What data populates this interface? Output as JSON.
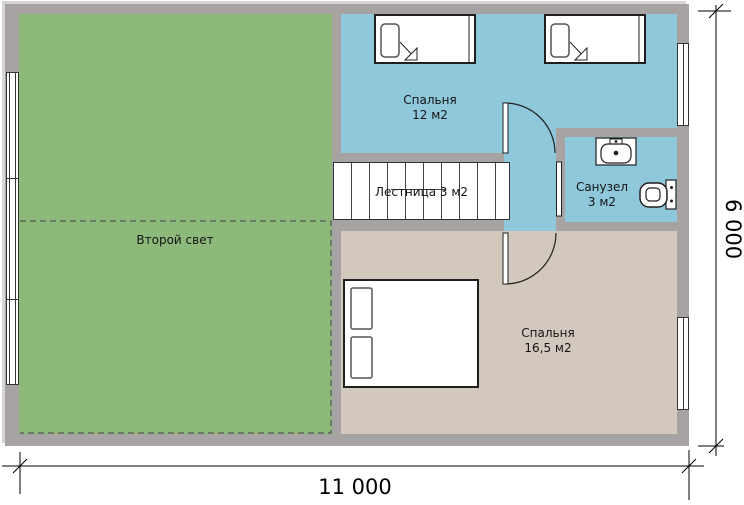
{
  "plan": {
    "title": "Floor plan, second level",
    "rooms": {
      "second_light": {
        "name": "Второй свет"
      },
      "bedroom_small": {
        "name": "Спальня",
        "area": "12 м2"
      },
      "bathroom": {
        "name": "Санузел",
        "area": "3 м2"
      },
      "stairs": {
        "name": "Лестница 3 м2"
      },
      "bedroom_large": {
        "name": "Спальня",
        "area": "16,5 м2"
      }
    },
    "dimensions": {
      "width": "11 000",
      "height": "6 000"
    }
  },
  "colors": {
    "wall": "#a6a3a2",
    "outline": "#d6d5d4",
    "floor_green": "#8dba7b",
    "floor_blue": "#8fc7db",
    "floor_beige": "#d2c8be",
    "line": "#1f1f1f"
  }
}
